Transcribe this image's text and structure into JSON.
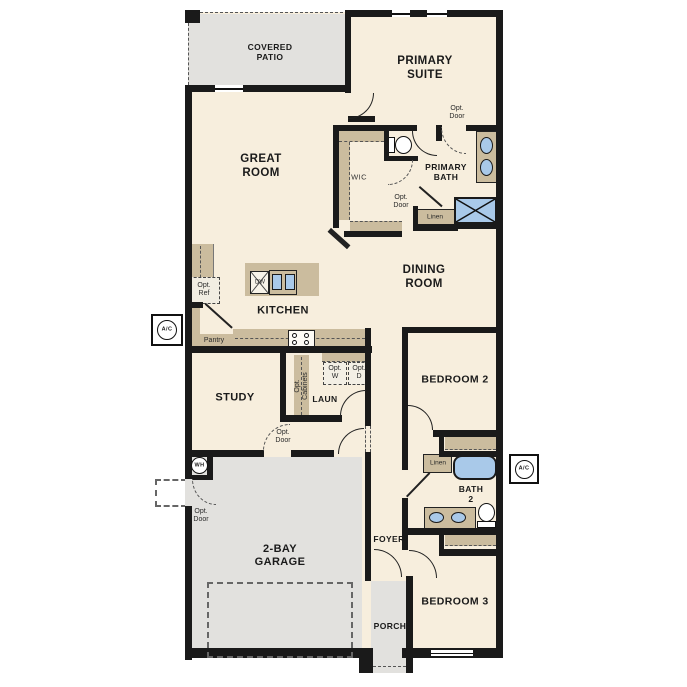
{
  "plan_title": "single-story floor plan",
  "colors": {
    "wall": "#1a1a1a",
    "floor": "#f7eedd",
    "cabinetry": "#cbbc9e",
    "hardscape": "#e2e1de",
    "fixture_blue": "#a9c9e9",
    "dashed_optional": "#555555"
  },
  "rooms": {
    "covered_patio": "COVERED\nPATIO",
    "primary_suite": "PRIMARY\nSUITE",
    "great_room": "GREAT\nROOM",
    "wic": "WIC",
    "primary_bath": "PRIMARY\nBATH",
    "dining_room": "DINING\nROOM",
    "kitchen": "KITCHEN",
    "study": "STUDY",
    "laundry": "LAUN",
    "bedroom2": "BEDROOM 2",
    "bath2": "BATH\n2",
    "bedroom3": "BEDROOM 3",
    "garage": "2-BAY\nGARAGE",
    "foyer": "FOYER",
    "porch": "PORCH"
  },
  "annotations": {
    "opt_door": "Opt.\nDoor",
    "opt_ref": "Opt.\nRef",
    "opt_washer": "Opt.\nW",
    "opt_dryer": "Opt.\nD",
    "opt_cabinets": "Opt.\nCabinets",
    "pantry": "Pantry",
    "linen": "Linen",
    "dishwasher": "DW",
    "water_heater": "WH",
    "ac_unit": "A/C"
  }
}
